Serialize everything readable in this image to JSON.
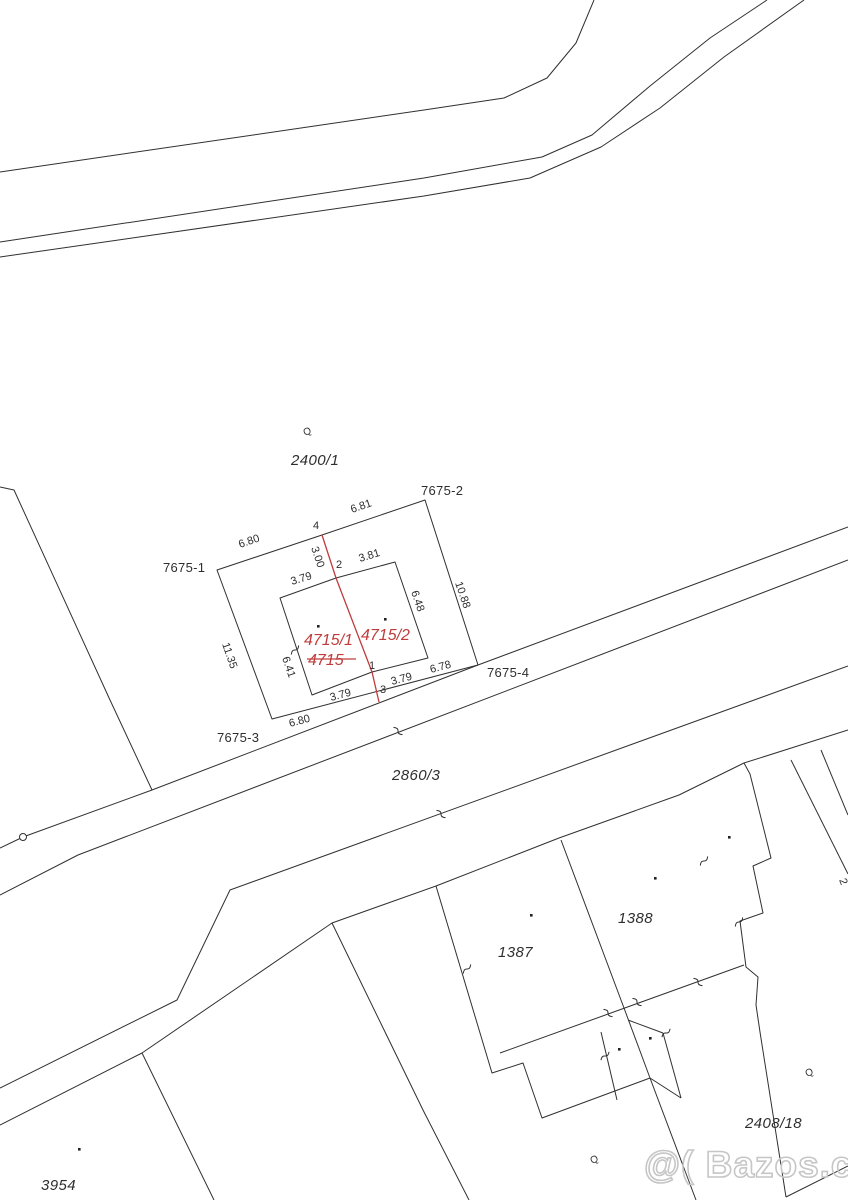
{
  "image": {
    "width": 848,
    "height": 1200,
    "kind": "cadastral-map-sketch"
  },
  "colors": {
    "background": "#ffffff",
    "line": "#303030",
    "red_accent": "#c03c3c",
    "watermark_gray": "#c6c6c6"
  },
  "watermark": {
    "text": "@( Bazos.cz"
  },
  "parcel_labels": [
    {
      "text": "2400/1"
    },
    {
      "text": "7675-1"
    },
    {
      "text": "7675-2"
    },
    {
      "text": "7675-3"
    },
    {
      "text": "7675-4"
    },
    {
      "text": "2860/3"
    },
    {
      "text": "1387"
    },
    {
      "text": "1388"
    },
    {
      "text": "2408/18"
    },
    {
      "text": "3954"
    },
    {
      "text": "4715/1"
    },
    {
      "text": "4715/2"
    },
    {
      "text": "4715"
    }
  ],
  "measurements": [
    {
      "text": "6.80"
    },
    {
      "text": "6.81"
    },
    {
      "text": "3.00"
    },
    {
      "text": "3.79"
    },
    {
      "text": "3.81"
    },
    {
      "text": "6.48"
    },
    {
      "text": "10.88"
    },
    {
      "text": "11.35"
    },
    {
      "text": "6.41"
    },
    {
      "text": "3.79"
    },
    {
      "text": "3.79"
    },
    {
      "text": "6.78"
    },
    {
      "text": "6.80"
    }
  ],
  "boundary_points": [
    {
      "text": "4"
    },
    {
      "text": "2"
    },
    {
      "text": "1"
    },
    {
      "text": "3"
    }
  ],
  "symbols": {
    "utility_pole": "Q",
    "edge_label_fragment": "2"
  }
}
